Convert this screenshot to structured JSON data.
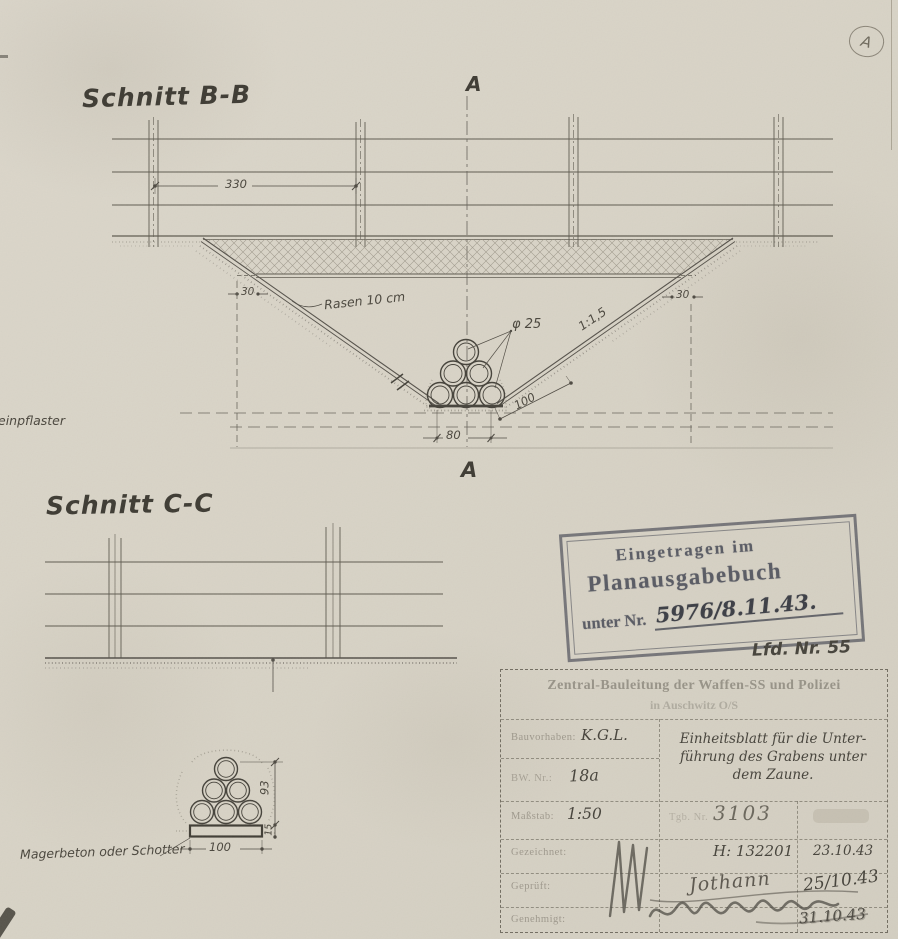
{
  "sheet": {
    "corner_mark": "A"
  },
  "section_bb": {
    "title": "Schnitt B-B",
    "cut_label_top": "A",
    "cut_label_bottom": "A",
    "dims": {
      "post_spacing": "330",
      "berm_left": "30",
      "berm_right": "30",
      "slope_length": "100",
      "bottom_width": "80"
    },
    "labels": {
      "turf": "Rasen 10 cm",
      "slope_ratio": "1:1,5",
      "pipe_diameter": "φ 25",
      "paving": "einpflaster"
    }
  },
  "section_cc": {
    "title": "Schnitt C-C"
  },
  "pipe_detail": {
    "dims": {
      "height": "93",
      "bedding_thickness": "15",
      "base_width": "100"
    },
    "label_bedding": "Magerbeton oder Schotter"
  },
  "registry_stamp": {
    "line1": "Eingetragen im",
    "line2": "Planausgabebuch",
    "line3_label": "unter Nr.",
    "line3_value": "5976/8.11.43."
  },
  "serial_note": "Lfd. Nr. 55",
  "title_block": {
    "header_line1": "Zentral-Bauleitung der Waffen-SS und Polizei",
    "header_line2": "in Auschwitz O/S",
    "bauvorhaben_label": "Bauvorhaben:",
    "bauvorhaben_value": "K.G.L.",
    "bw_label": "BW. Nr.:",
    "bw_value": "18a",
    "massstab_label": "Maßstab:",
    "massstab_value": "1:50",
    "zeichnung_label": "Tgb. Nr.",
    "zeichnung_value": "3103",
    "description_line1": "Einheitsblatt für die Unter-",
    "description_line2": "führung des Grabens unter",
    "description_line3": "dem Zaune.",
    "gezeichnet_label": "Gezeichnet:",
    "gezeichnet_value": "H: 132201",
    "gezeichnet_date": "23.10.43",
    "geprueft_label": "Geprüft:",
    "geprueft_signature": "Jothann",
    "geprueft_date": "25/10.43",
    "genehmigt_label": "Genehmigt:",
    "genehmigt_date": "31.10.43"
  }
}
